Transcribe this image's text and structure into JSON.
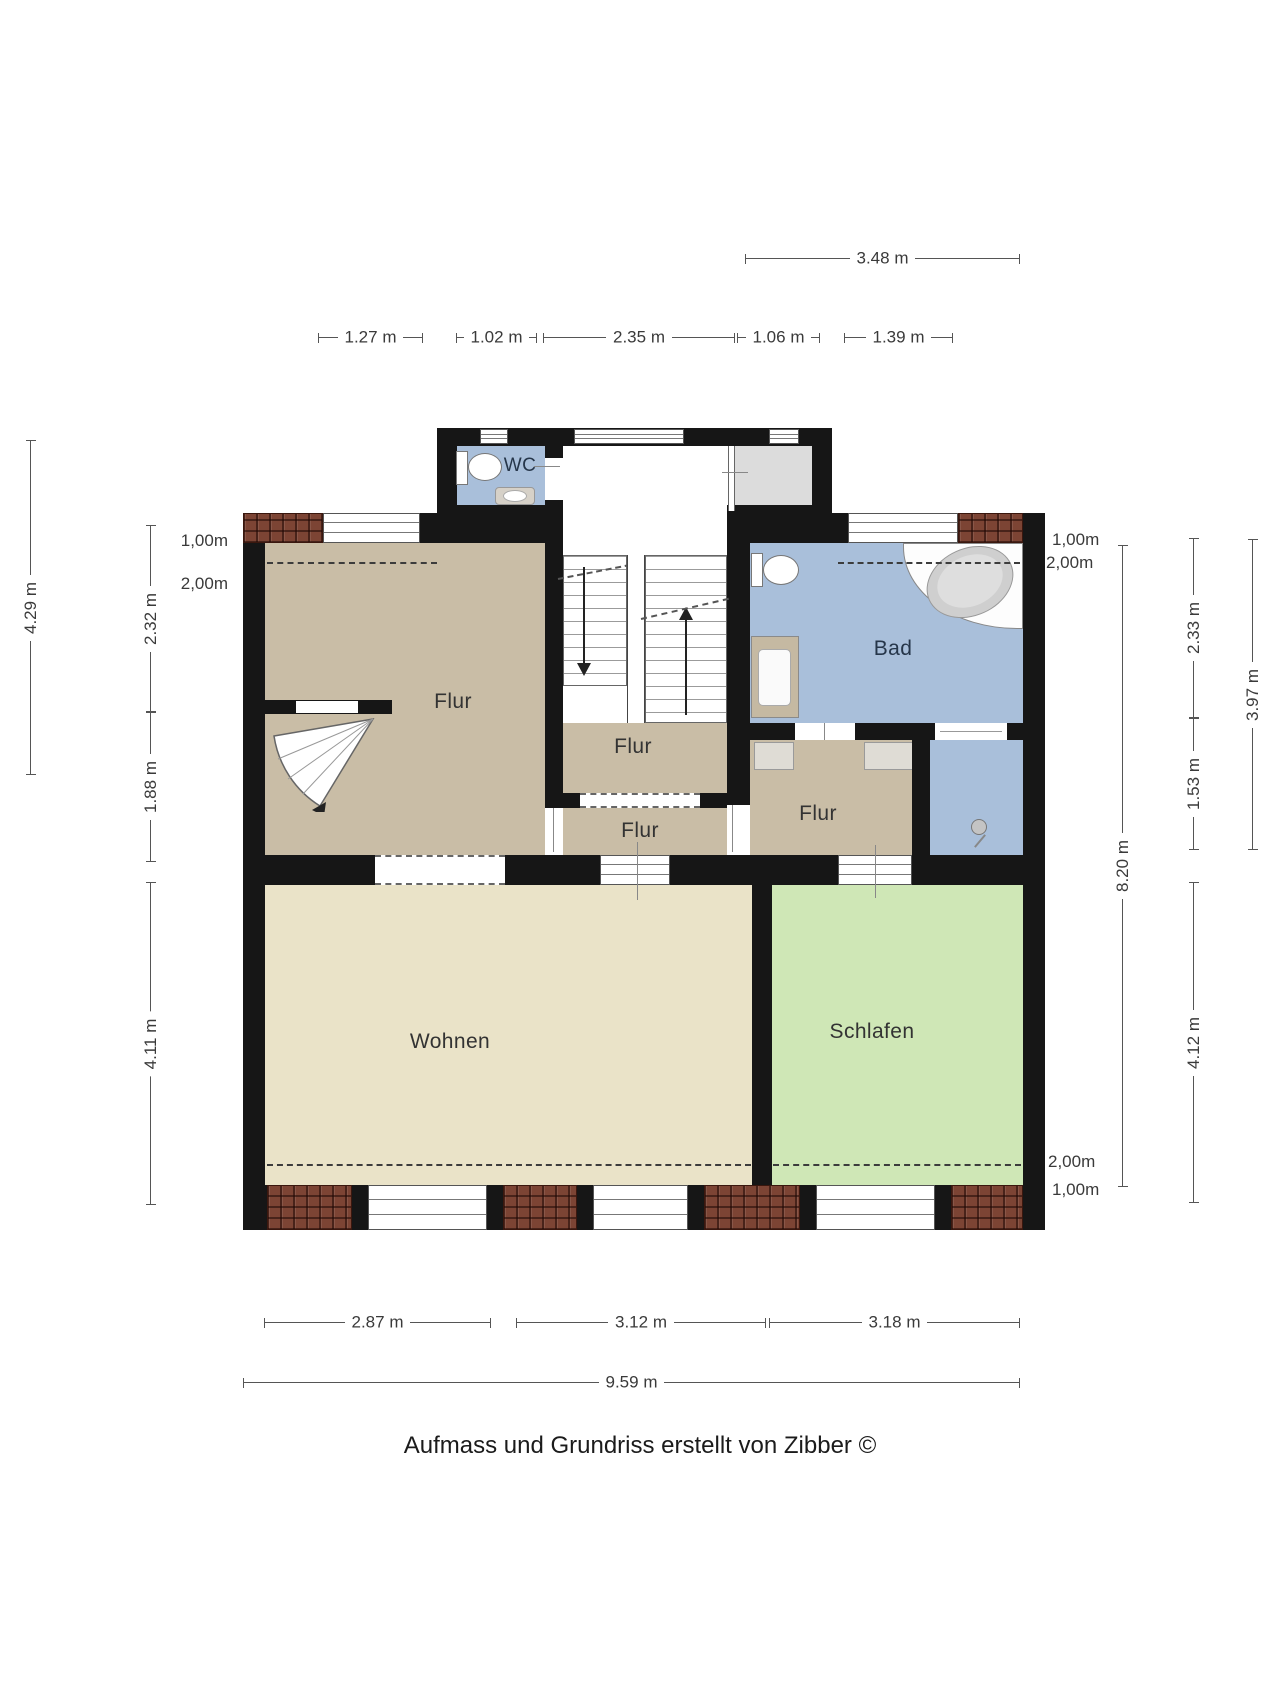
{
  "footer": {
    "credit": "Aufmass und Grundriss erstellt von Zibber ©"
  },
  "rooms": {
    "wc": "WC",
    "bad": "Bad",
    "flur_left": "Flur",
    "flur_stairs": "Flur",
    "flur_corridor": "Flur",
    "flur_right": "Flur",
    "wohnen": "Wohnen",
    "schlafen": "Schlafen"
  },
  "dimensions": {
    "top_total": "3.48 m",
    "top_segments": [
      "1.27 m",
      "1.02 m",
      "2.35 m",
      "1.06 m",
      "1.39 m"
    ],
    "left_outer": "4.29 m",
    "left_segments": [
      "2.32 m",
      "1.88 m",
      "4.11 m"
    ],
    "left_height_marks": [
      "1,00m",
      "2,00m"
    ],
    "right_total": "8.20 m",
    "right_segments": [
      "2.33 m",
      "1.53 m"
    ],
    "right_mid_total": "3.97 m",
    "right_lower_segment": "4.12 m",
    "right_height_marks_top": [
      "1,00m",
      "2,00m"
    ],
    "right_height_marks_bottom": [
      "2,00m",
      "1,00m"
    ],
    "bottom_segments": [
      "2.87 m",
      "3.12 m",
      "3.18 m"
    ],
    "bottom_total": "9.59 m"
  },
  "colors": {
    "wall": "#161616",
    "corridor_floor": "#c9bda6",
    "living_floor": "#eae3c8",
    "sleeping_floor": "#cfe7b6",
    "bath_floor": "#a9bfda",
    "vestibule_floor": "#dcdcdc",
    "brick": "#7c4434",
    "dimension_text": "#3a3a3a"
  }
}
